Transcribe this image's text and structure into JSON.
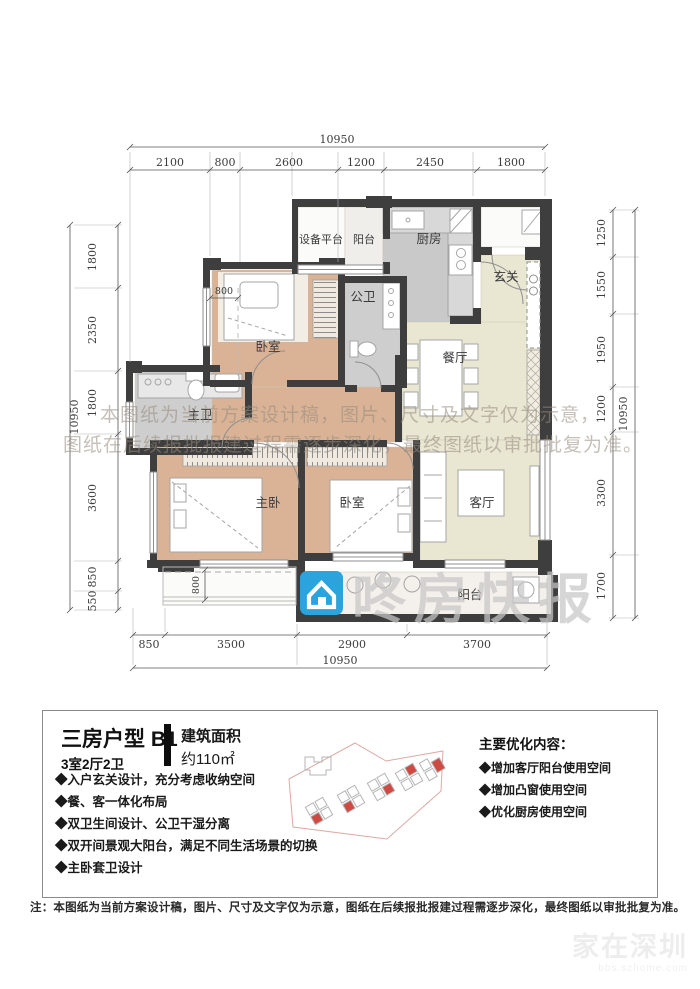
{
  "plan": {
    "dims": {
      "top_total": "10950",
      "top": [
        "2100",
        "800",
        "2600",
        "1200",
        "2450",
        "1800"
      ],
      "left": [
        "1800",
        "2350",
        "1800",
        "3600",
        "850",
        "550"
      ],
      "left_total": "10950",
      "right": [
        "1250",
        "1550",
        "1950",
        "1200",
        "3300",
        "1700"
      ],
      "right_total": "10950",
      "bottom": [
        "850",
        "3500",
        "2900",
        "3700"
      ],
      "bottom_total": "10950",
      "inner_bedroom_window": "800",
      "inner_balcony": "800"
    },
    "rooms": {
      "equipment_platform": "设备平台",
      "balcony_top": "阳台",
      "kitchen": "厨房",
      "entry": "玄关",
      "public_bath": "公卫",
      "bedroom_top": "卧室",
      "dining": "餐厅",
      "master_bath": "主卫",
      "master_bedroom": "主卧",
      "bedroom_mid": "卧室",
      "living": "客厅",
      "balcony_bottom": "阳台"
    },
    "watermark": {
      "line1": "本图纸为当前方案设计稿，图片、尺寸及文字仅为示意，",
      "line2": "图纸在后续报批报建过程需逐步深化，最终图纸以审批批复为准。",
      "brand": "咚房快报"
    }
  },
  "footer": {
    "title": "三房户型 B1",
    "subtitle": "3室2厅2卫",
    "area_label": "建筑面积",
    "area_value": "约110㎡",
    "features": [
      "◆入户玄关设计，充分考虑收纳空间",
      "◆餐、客一体化布局",
      "◆双卫生间设计、公卫干湿分离",
      "◆双开间景观大阳台，满足不同生活场景的切换",
      "◆主卧套卫设计"
    ],
    "optimize_title": "主要优化内容：",
    "optimizations": [
      "◆增加客厅阳台使用空间",
      "◆增加凸窗使用空间",
      "◆优化厨房使用空间"
    ]
  },
  "note": "注：本图纸为当前方案设计稿，图片、尺寸及文字仅为示意，图纸在后续报批报建过程需逐步深化，最终图纸以审批批复为准。",
  "corner_watermark": {
    "line1": "家在深圳",
    "line2": "bbs.szhome.com"
  },
  "colors": {
    "wall": "#3e3e3e",
    "floor_beige": "#e9e6d2",
    "floor_tan": "#d9b294",
    "floor_gray": "#cbcbcb",
    "logo_blue": "#2ba3dc",
    "site_red": "#cf4a42"
  }
}
